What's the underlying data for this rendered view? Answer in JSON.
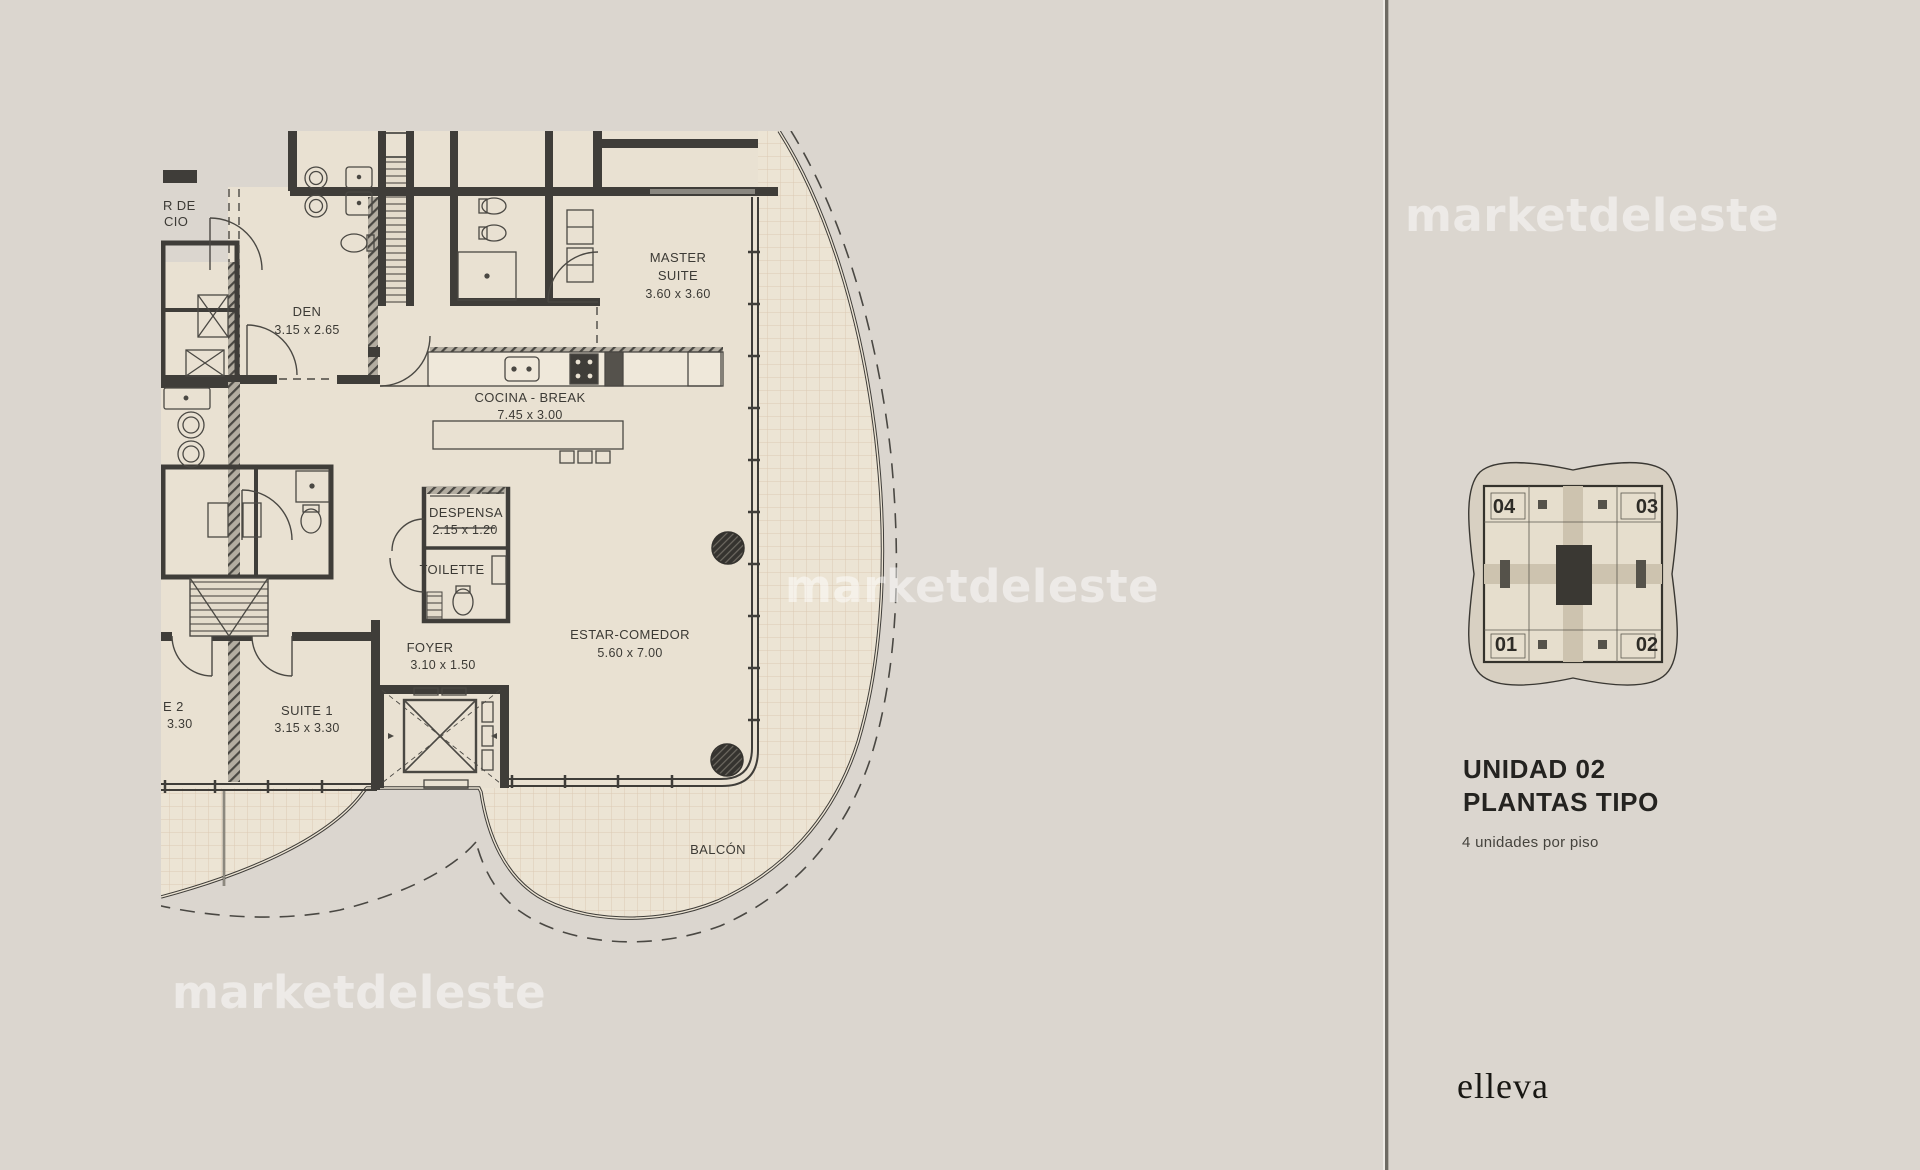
{
  "plan": {
    "rooms": {
      "den": {
        "name": "DEN",
        "dims": "3.15 x 2.65"
      },
      "master": {
        "name1": "MASTER",
        "name2": "SUITE",
        "dims": "3.60 x 3.60"
      },
      "cocina": {
        "name": "COCINA - BREAK",
        "dims": "7.45 x 3.00"
      },
      "despensa": {
        "name": "DESPENSA",
        "dims": "2.15 x 1.20"
      },
      "toilette": {
        "name": "TOILETTE"
      },
      "foyer": {
        "name": "FOYER",
        "dims": "3.10 x 1.50"
      },
      "estar": {
        "name": "ESTAR-COMEDOR",
        "dims": "5.60 x 7.00"
      },
      "suite1": {
        "name": "SUITE 1",
        "dims": "3.15 x 3.30"
      },
      "suite2_partial": {
        "name": "E 2",
        "dims": "3.30"
      },
      "palier_partial": {
        "line1": "R DE",
        "line2": "CIO"
      },
      "balcon": {
        "name": "BALCÓN"
      }
    }
  },
  "panel": {
    "keyplan_units": {
      "tl": "04",
      "tr": "03",
      "bl": "01",
      "br": "02"
    },
    "title1": "UNIDAD 02",
    "title2": "PLANTAS TIPO",
    "subtitle": "4 unidades por piso",
    "brand": "elleva"
  },
  "watermark": {
    "text": "marketdeleste"
  },
  "colors": {
    "background": "#dbd6cf",
    "plan_floor": "#e9e1d2",
    "balcony_floor": "#ece4d4",
    "balcony_grid": "#dccab4",
    "wall": "#3f3d39",
    "label_text": "#3c3a35",
    "heading_text": "#242320",
    "watermark": "#ffffff"
  }
}
